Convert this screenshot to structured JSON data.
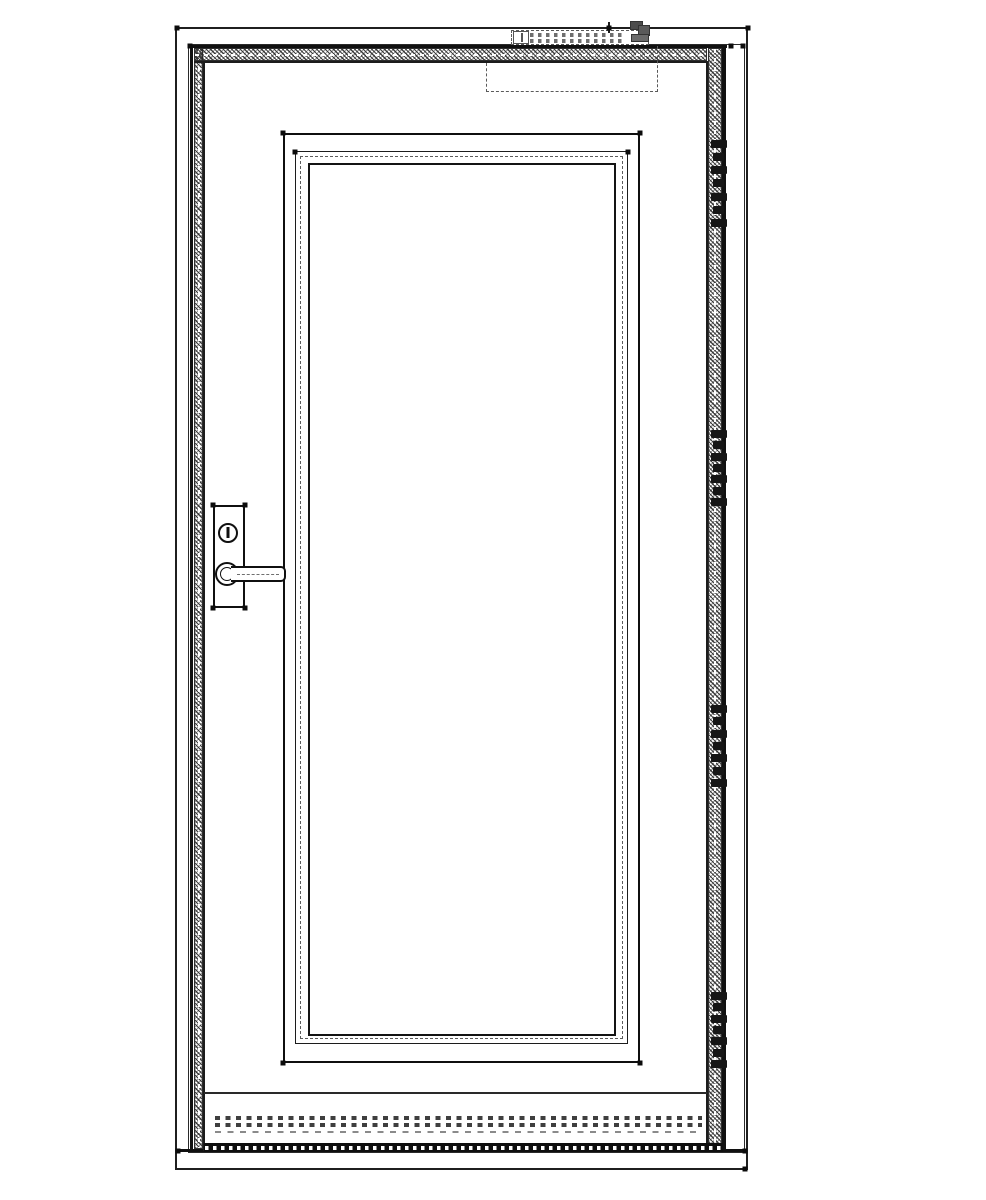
{
  "drawing": {
    "kind": "door-elevation-technical-drawing",
    "background_color": "#ffffff",
    "ink_color": "#1a1a1a",
    "hidden_line_color": "#5a5a5a",
    "components": {
      "opening_outline": "wall opening outline",
      "door_frame": "frame with perimeter seal hatch",
      "door_leaf": "single leaf with glazing panel",
      "glazing_panel": "triple frame with dash-dot glass line",
      "lockset": "escutcheon plate, cylinder above lever handle",
      "door_closer": "hidden slide-rail closer at head",
      "threshold": "gasket lines and brush seal at sill"
    },
    "hinge_style": {
      "knuckles": 7,
      "widths": [
        16,
        11,
        16,
        11,
        16,
        11,
        16
      ],
      "knuckle_height": 8
    },
    "hinges": [
      {
        "y": 140,
        "h": 87
      },
      {
        "y": 430,
        "h": 76
      },
      {
        "y": 705,
        "h": 82
      },
      {
        "y": 992,
        "h": 76
      }
    ],
    "node_dots": [
      [
        177,
        28
      ],
      [
        748,
        28
      ],
      [
        190,
        46
      ],
      [
        731,
        46
      ],
      [
        743,
        46
      ],
      [
        178,
        1151
      ],
      [
        745,
        1151
      ],
      [
        745,
        1169
      ],
      [
        283,
        133
      ],
      [
        640,
        133
      ],
      [
        283,
        1063
      ],
      [
        640,
        1063
      ],
      [
        295,
        152
      ],
      [
        628,
        152
      ],
      [
        213,
        505
      ],
      [
        245,
        505
      ],
      [
        213,
        608
      ],
      [
        245,
        608
      ],
      [
        609,
        28
      ]
    ]
  }
}
